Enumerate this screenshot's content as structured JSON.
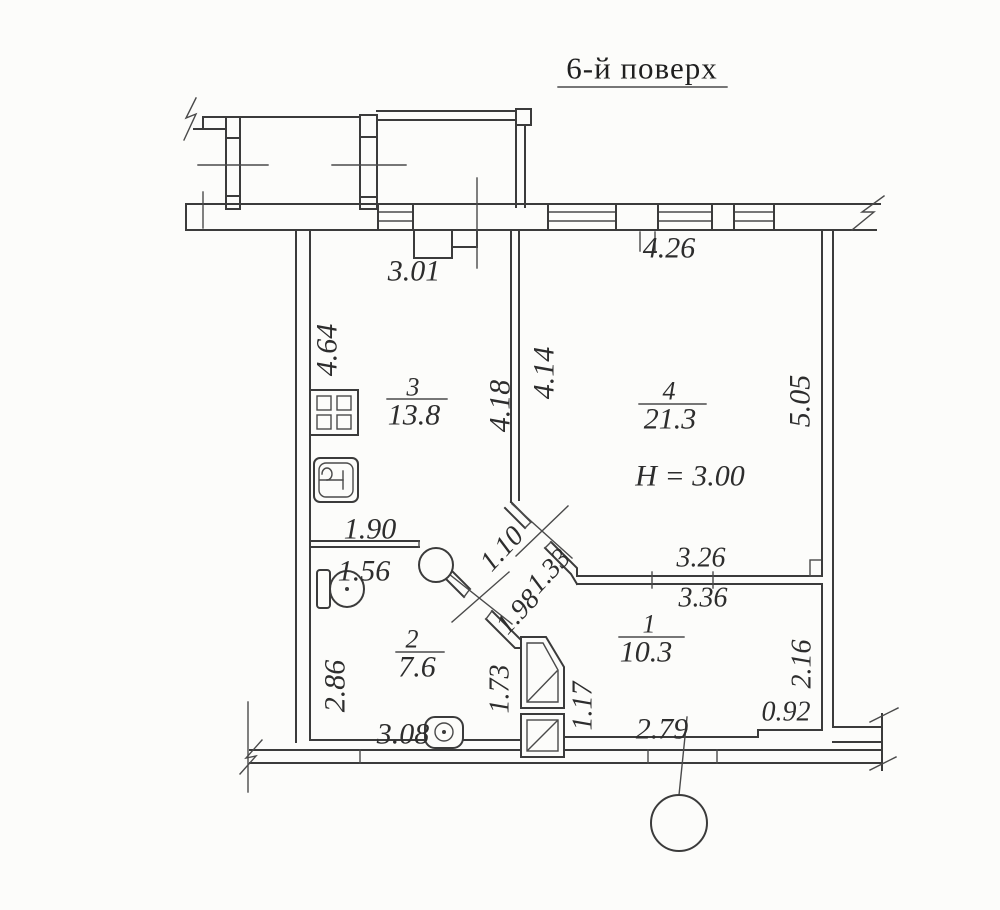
{
  "title": "6-й поверх",
  "rooms": {
    "room1": {
      "number": "1",
      "area": "10.3"
    },
    "room2": {
      "number": "2",
      "area": "7.6"
    },
    "room3": {
      "number": "3",
      "area": "13.8"
    },
    "room4": {
      "number": "4",
      "area": "21.3",
      "ceiling_height": "H  =  3.00"
    }
  },
  "dims": {
    "d301": "3.01",
    "d426": "4.26",
    "d464": "4.64",
    "d418": "4.18",
    "d414": "4.14",
    "d505": "5.05",
    "d190": "1.90",
    "d156": "1.56",
    "d110": "1.10",
    "d133": "1.33",
    "d198": "1.98",
    "d326": "3.26",
    "d336": "3.36",
    "d286": "2.86",
    "d308": "3.08",
    "d173": "1.73",
    "d117": "1.17",
    "d216": "2.16",
    "d092": "0.92",
    "d279": "2.79"
  },
  "icons": {
    "stove": "stove-icon",
    "sink": "sink-icon",
    "toilet": "toilet-icon",
    "washer": "washer-icon",
    "column": "column-circle",
    "callout": "callout-circle"
  },
  "colors": {
    "ink": "#3b3b3b",
    "paper": "#fcfcfa"
  }
}
